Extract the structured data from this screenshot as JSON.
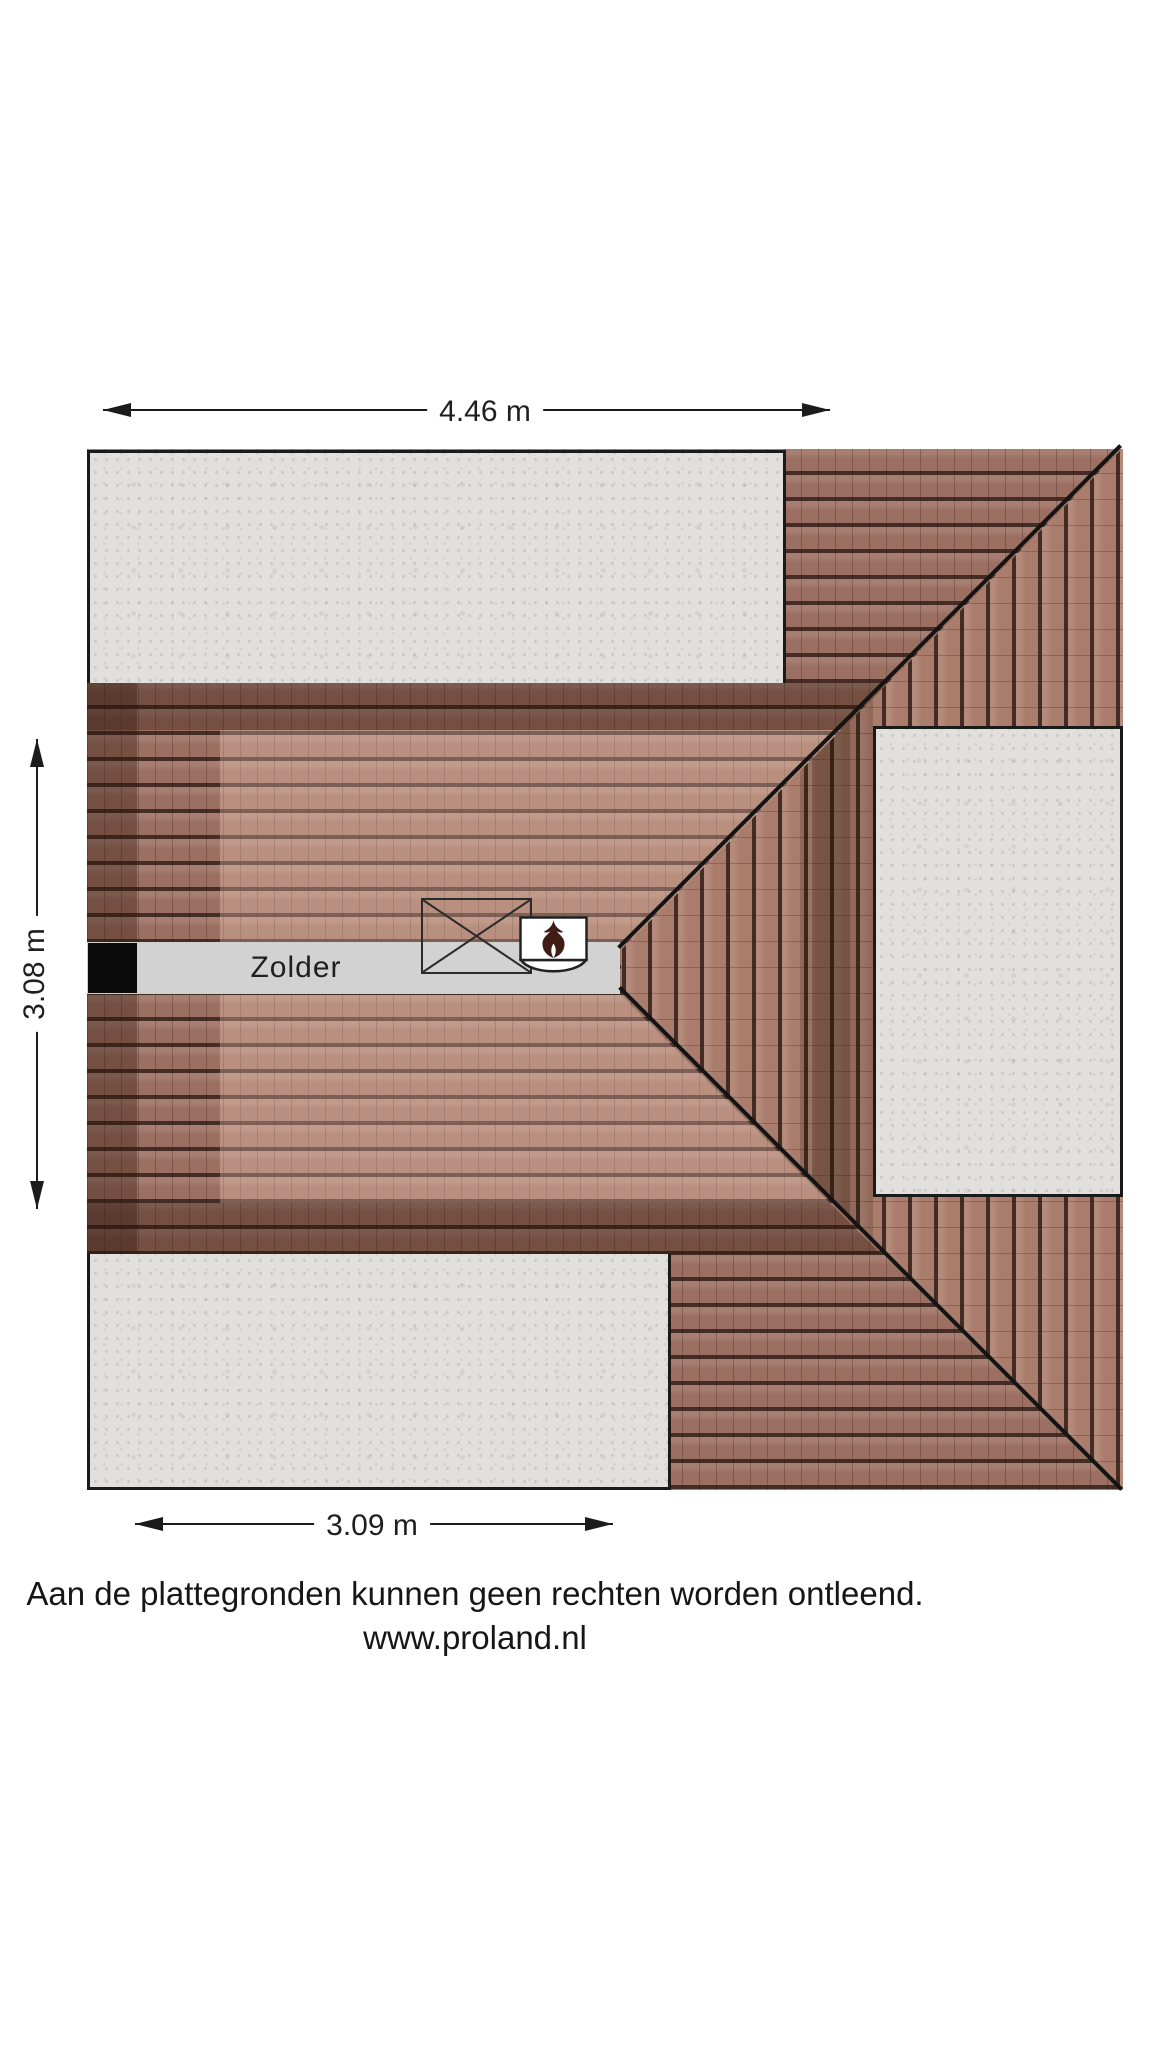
{
  "room": {
    "label": "Zolder"
  },
  "dimensions": {
    "top": {
      "label": "4.46 m"
    },
    "left": {
      "label": "3.08 m"
    },
    "bottom": {
      "label": "3.09 m"
    }
  },
  "footer": {
    "disclaimer": "Aan de plattegronden kunnen geen rechten worden ontleend.",
    "website": "www.proland.nl"
  },
  "icons": {
    "boiler_flame": "flame-icon",
    "stair_opening_cross": "cross-icon"
  },
  "colors": {
    "background": "#ffffff",
    "roof_tile_field": "#9b6f62",
    "roof_tile_east": "#aa7c6c",
    "roof_tile_dark_band": "#6b463a",
    "roof_tile_light_inner": "#b58878",
    "tile_joint_line": "#2e1a12",
    "concrete_insert": "#e1e0dd",
    "attic_floor": "#d2d2d2",
    "chimney": "#0b0b0b",
    "plan_line": "#141414",
    "text": "#1f1f1f"
  }
}
